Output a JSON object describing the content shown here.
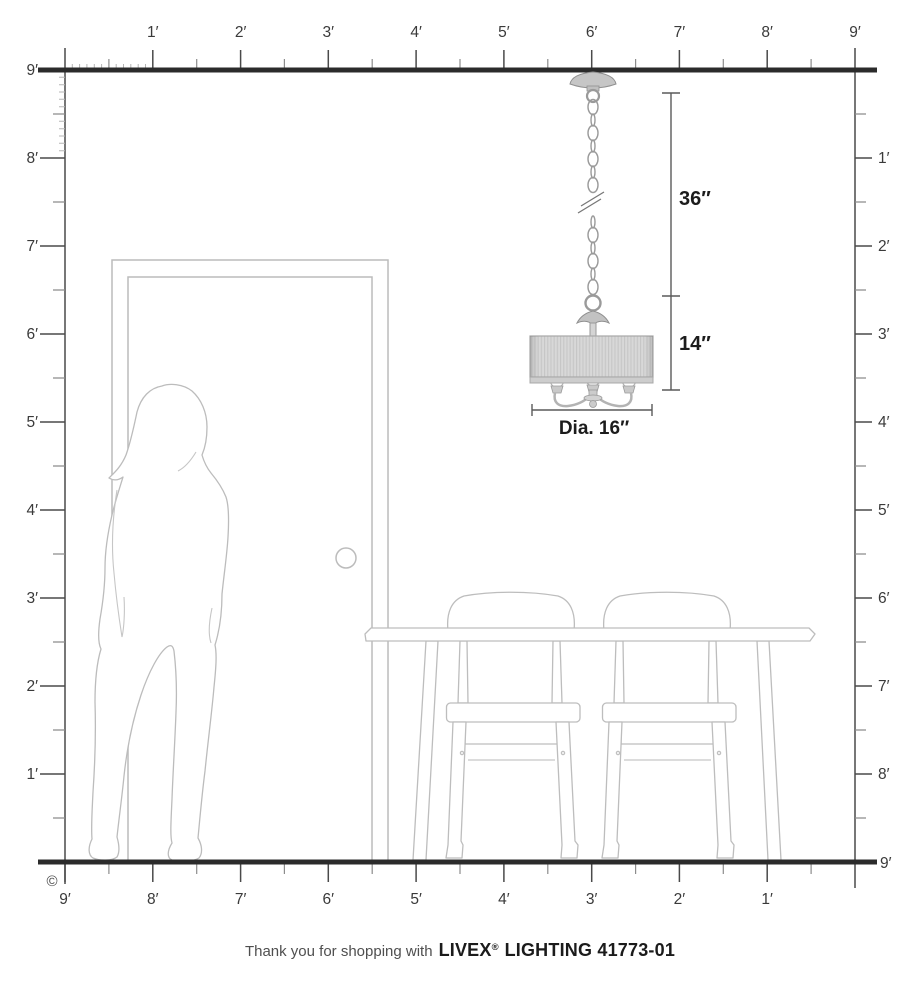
{
  "rulers": {
    "top": {
      "labels": [
        "1′",
        "2′",
        "3′",
        "4′",
        "5′",
        "6′",
        "7′",
        "8′",
        "9′"
      ]
    },
    "left": {
      "labels": [
        "9′",
        "8′",
        "7′",
        "6′",
        "5′",
        "4′",
        "3′",
        "2′",
        "1′"
      ]
    },
    "right": {
      "labels": [
        "1′",
        "2′",
        "3′",
        "4′",
        "5′",
        "6′",
        "7′",
        "8′",
        "9′"
      ]
    },
    "bottom": {
      "labels": [
        "9′",
        "8′",
        "7′",
        "6′",
        "5′",
        "4′",
        "3′",
        "2′",
        "1′"
      ]
    }
  },
  "dimensions": {
    "chain_length": "36″",
    "fixture_height": "14″",
    "diameter": "Dia. 16″"
  },
  "copyright_symbol": "©",
  "footer": {
    "prefix": "Thank you for shopping with",
    "brand": "LIVEX",
    "registered_mark": "®",
    "suffix": "LIGHTING 41773-01"
  },
  "colors": {
    "wall_line": "#2b2b2b",
    "ruler_major_tick": "#4a4a4a",
    "ruler_half_tick": "#8c8c8c",
    "ruler_inch_tick": "#b5b5b5",
    "label_text": "#3a3a3a",
    "outline_light_gray": "#bcbcbc",
    "fixture_metal": "#c6c6c6",
    "shade_base": "#d8d8d8",
    "shade_pleat": "#c6c6c6",
    "dimension_line": "#5a5a5a",
    "dimension_text": "#1c1c1c"
  }
}
